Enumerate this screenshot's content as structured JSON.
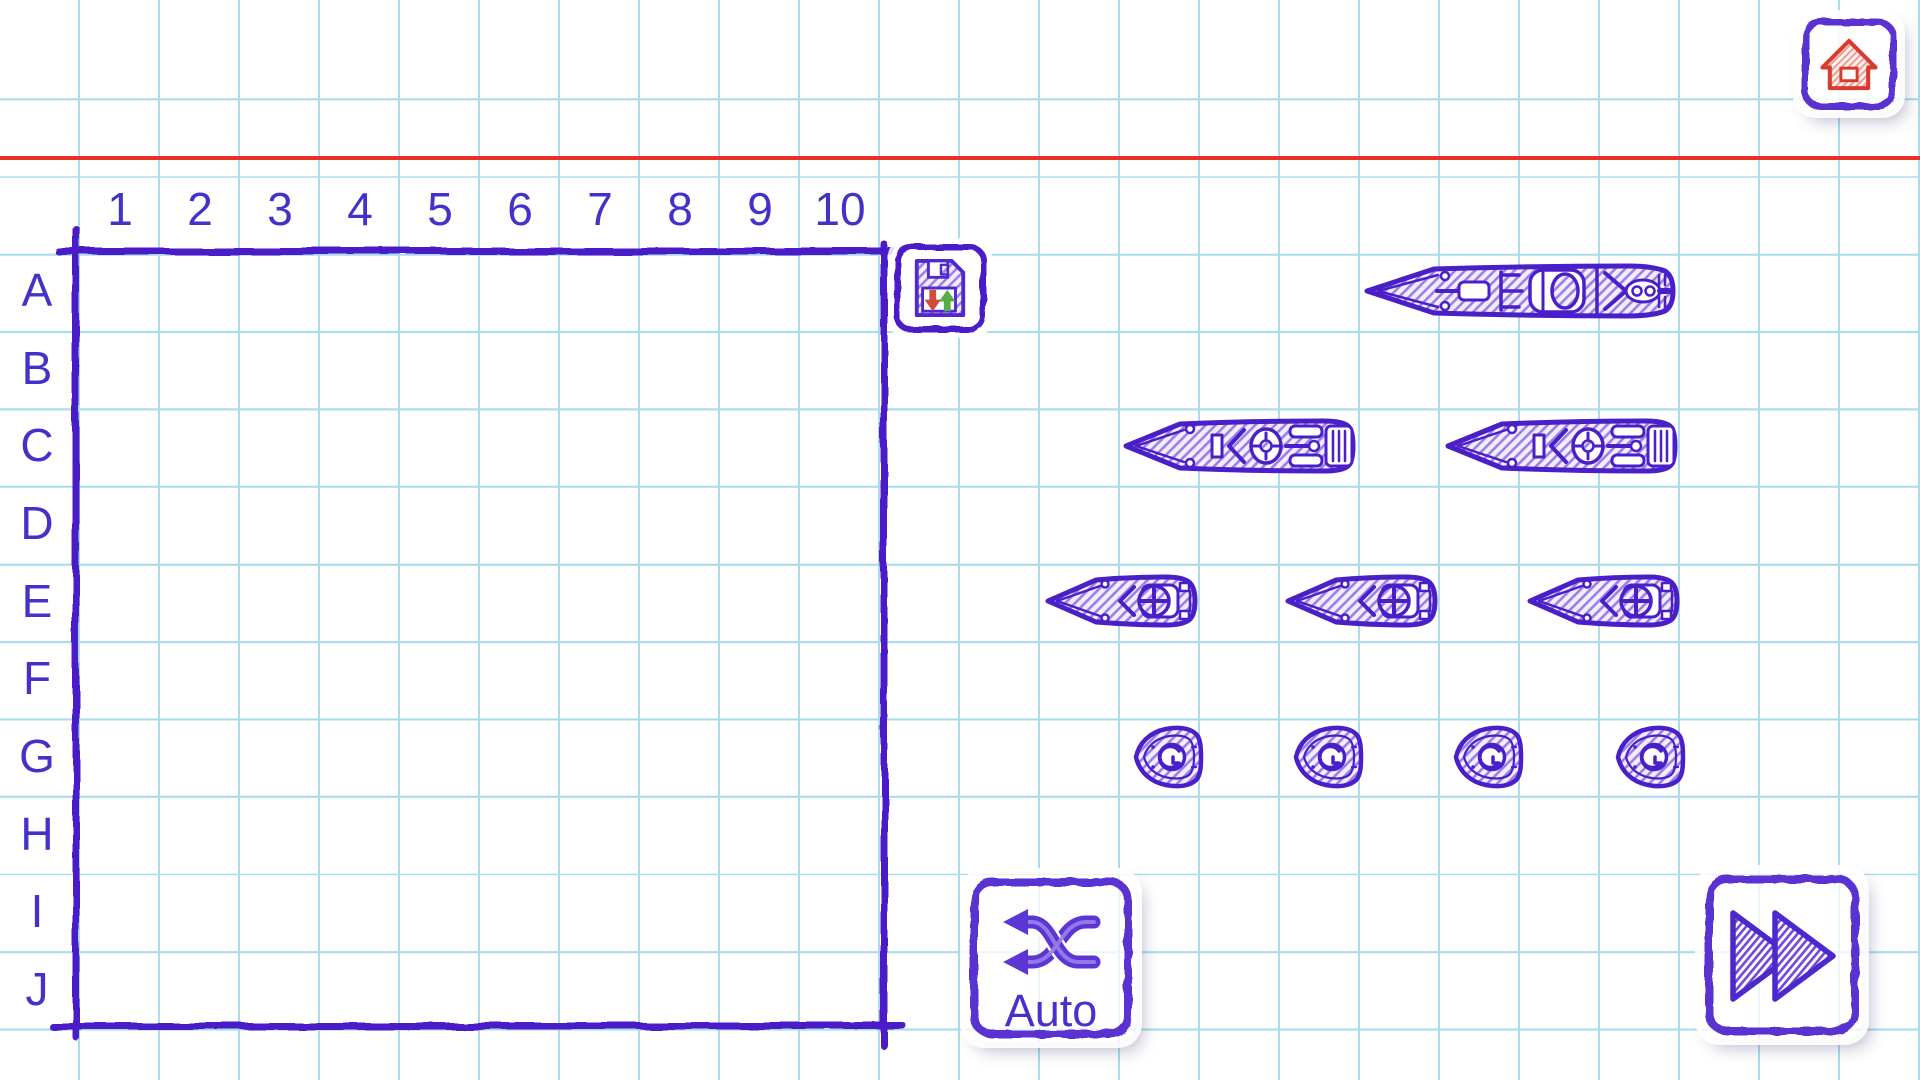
{
  "board": {
    "column_labels": [
      "1",
      "2",
      "3",
      "4",
      "5",
      "6",
      "7",
      "8",
      "9",
      "10"
    ],
    "row_labels": [
      "A",
      "B",
      "C",
      "D",
      "E",
      "F",
      "G",
      "H",
      "I",
      "J"
    ]
  },
  "buttons": {
    "home": {
      "icon": "home-icon"
    },
    "save": {
      "icon": "save-floppy-icon"
    },
    "auto": {
      "label": "Auto",
      "icon": "shuffle-icon"
    },
    "start": {
      "icon": "fast-forward-icon"
    }
  },
  "fleet": {
    "ships": [
      {
        "type": "battleship",
        "size": 4,
        "count": 1
      },
      {
        "type": "cruiser",
        "size": 3,
        "count": 2
      },
      {
        "type": "destroyer",
        "size": 2,
        "count": 3
      },
      {
        "type": "submarine",
        "size": 1,
        "count": 4
      }
    ]
  },
  "colors": {
    "ink": "#4a1fc8",
    "label_text": "#4431ca",
    "grid_line": "#a8dcee",
    "margin_line": "#e5332a",
    "home_red": "#d93a2e",
    "save_arrow_down": "#cf4c38",
    "save_arrow_up": "#57ab48",
    "paper": "#ffffff"
  }
}
